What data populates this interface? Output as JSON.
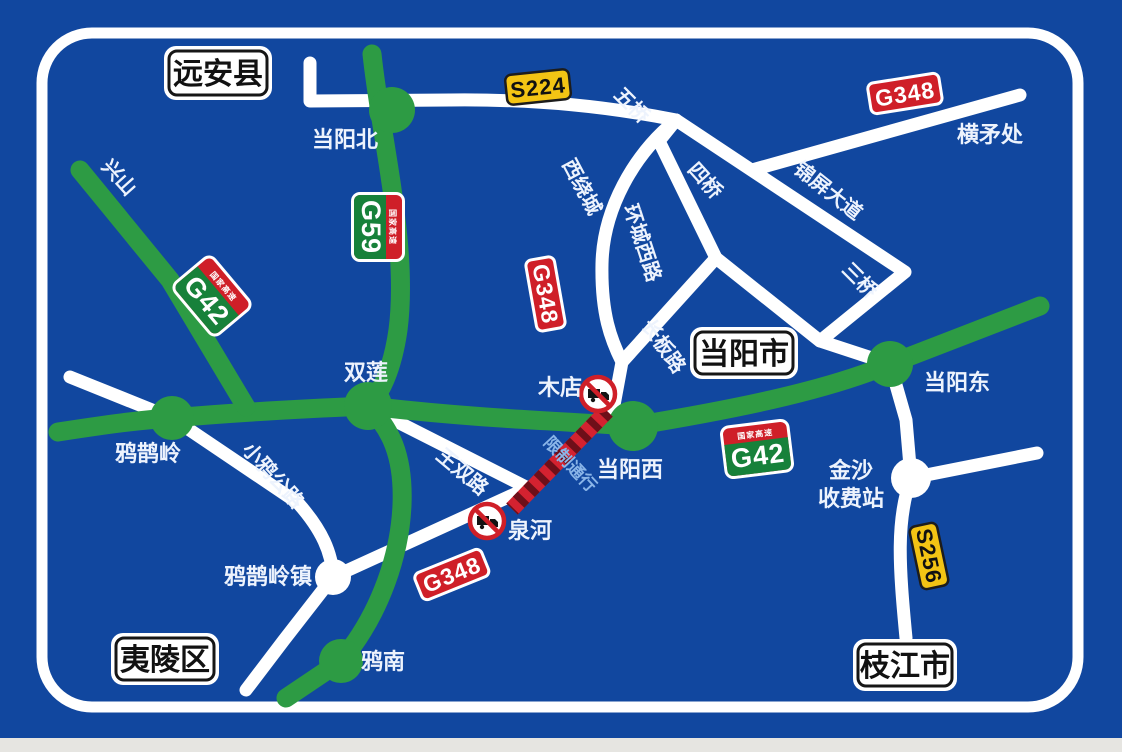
{
  "board": {
    "bg_color": "#11479f",
    "border_color": "#ffffff",
    "road_green": "#2d9b44",
    "road_white": "#ffffff",
    "restricted_red": "#d42230",
    "restricted_stripe_dark": "#6e0f19",
    "restriction_text_color": "#8ab5e8"
  },
  "area_boxes": {
    "yuanan_county": "远安县",
    "dangyang_city": "当阳市",
    "yiling_district": "夷陵区",
    "zhijiang_city": "枝江市"
  },
  "shields": {
    "s224": "S224",
    "s256": "S256",
    "g348_east": "G348",
    "g348_mid": "G348",
    "g348_south": "G348",
    "g59": {
      "band": "国家高速",
      "code": "G59"
    },
    "g42_west": {
      "band": "国家高速",
      "code": "G42"
    },
    "g42_mid": {
      "band": "国家高速",
      "code": "G42"
    }
  },
  "places": {
    "dangyang_north": "当阳北",
    "xingshan": "兴山",
    "shuanglian": "双莲",
    "wuqiao": "五桥",
    "siqiao": "四桥",
    "sanqiao": "三桥",
    "xiraocheng": "西绕城",
    "huancheng_west_rd": "环城西路",
    "changban_rd": "长板路",
    "jinping_avenue": "锦屏大道",
    "hengmaochu": "横矛处",
    "mudian": "木店",
    "dangyang_west": "当阳西",
    "dangyang_east": "当阳东",
    "yaque_ridge": "鸦鹊岭",
    "xiaoya_highway": "小鸦公路",
    "wangshuang_rd": "王双路",
    "jinsha_toll_line1": "金沙",
    "jinsha_toll_line2": "收费站",
    "yaque_ridge_town": "鸦鹊岭镇",
    "quanhe": "泉河",
    "yanan": "鸦南"
  },
  "restriction": {
    "label": "限制通行"
  }
}
